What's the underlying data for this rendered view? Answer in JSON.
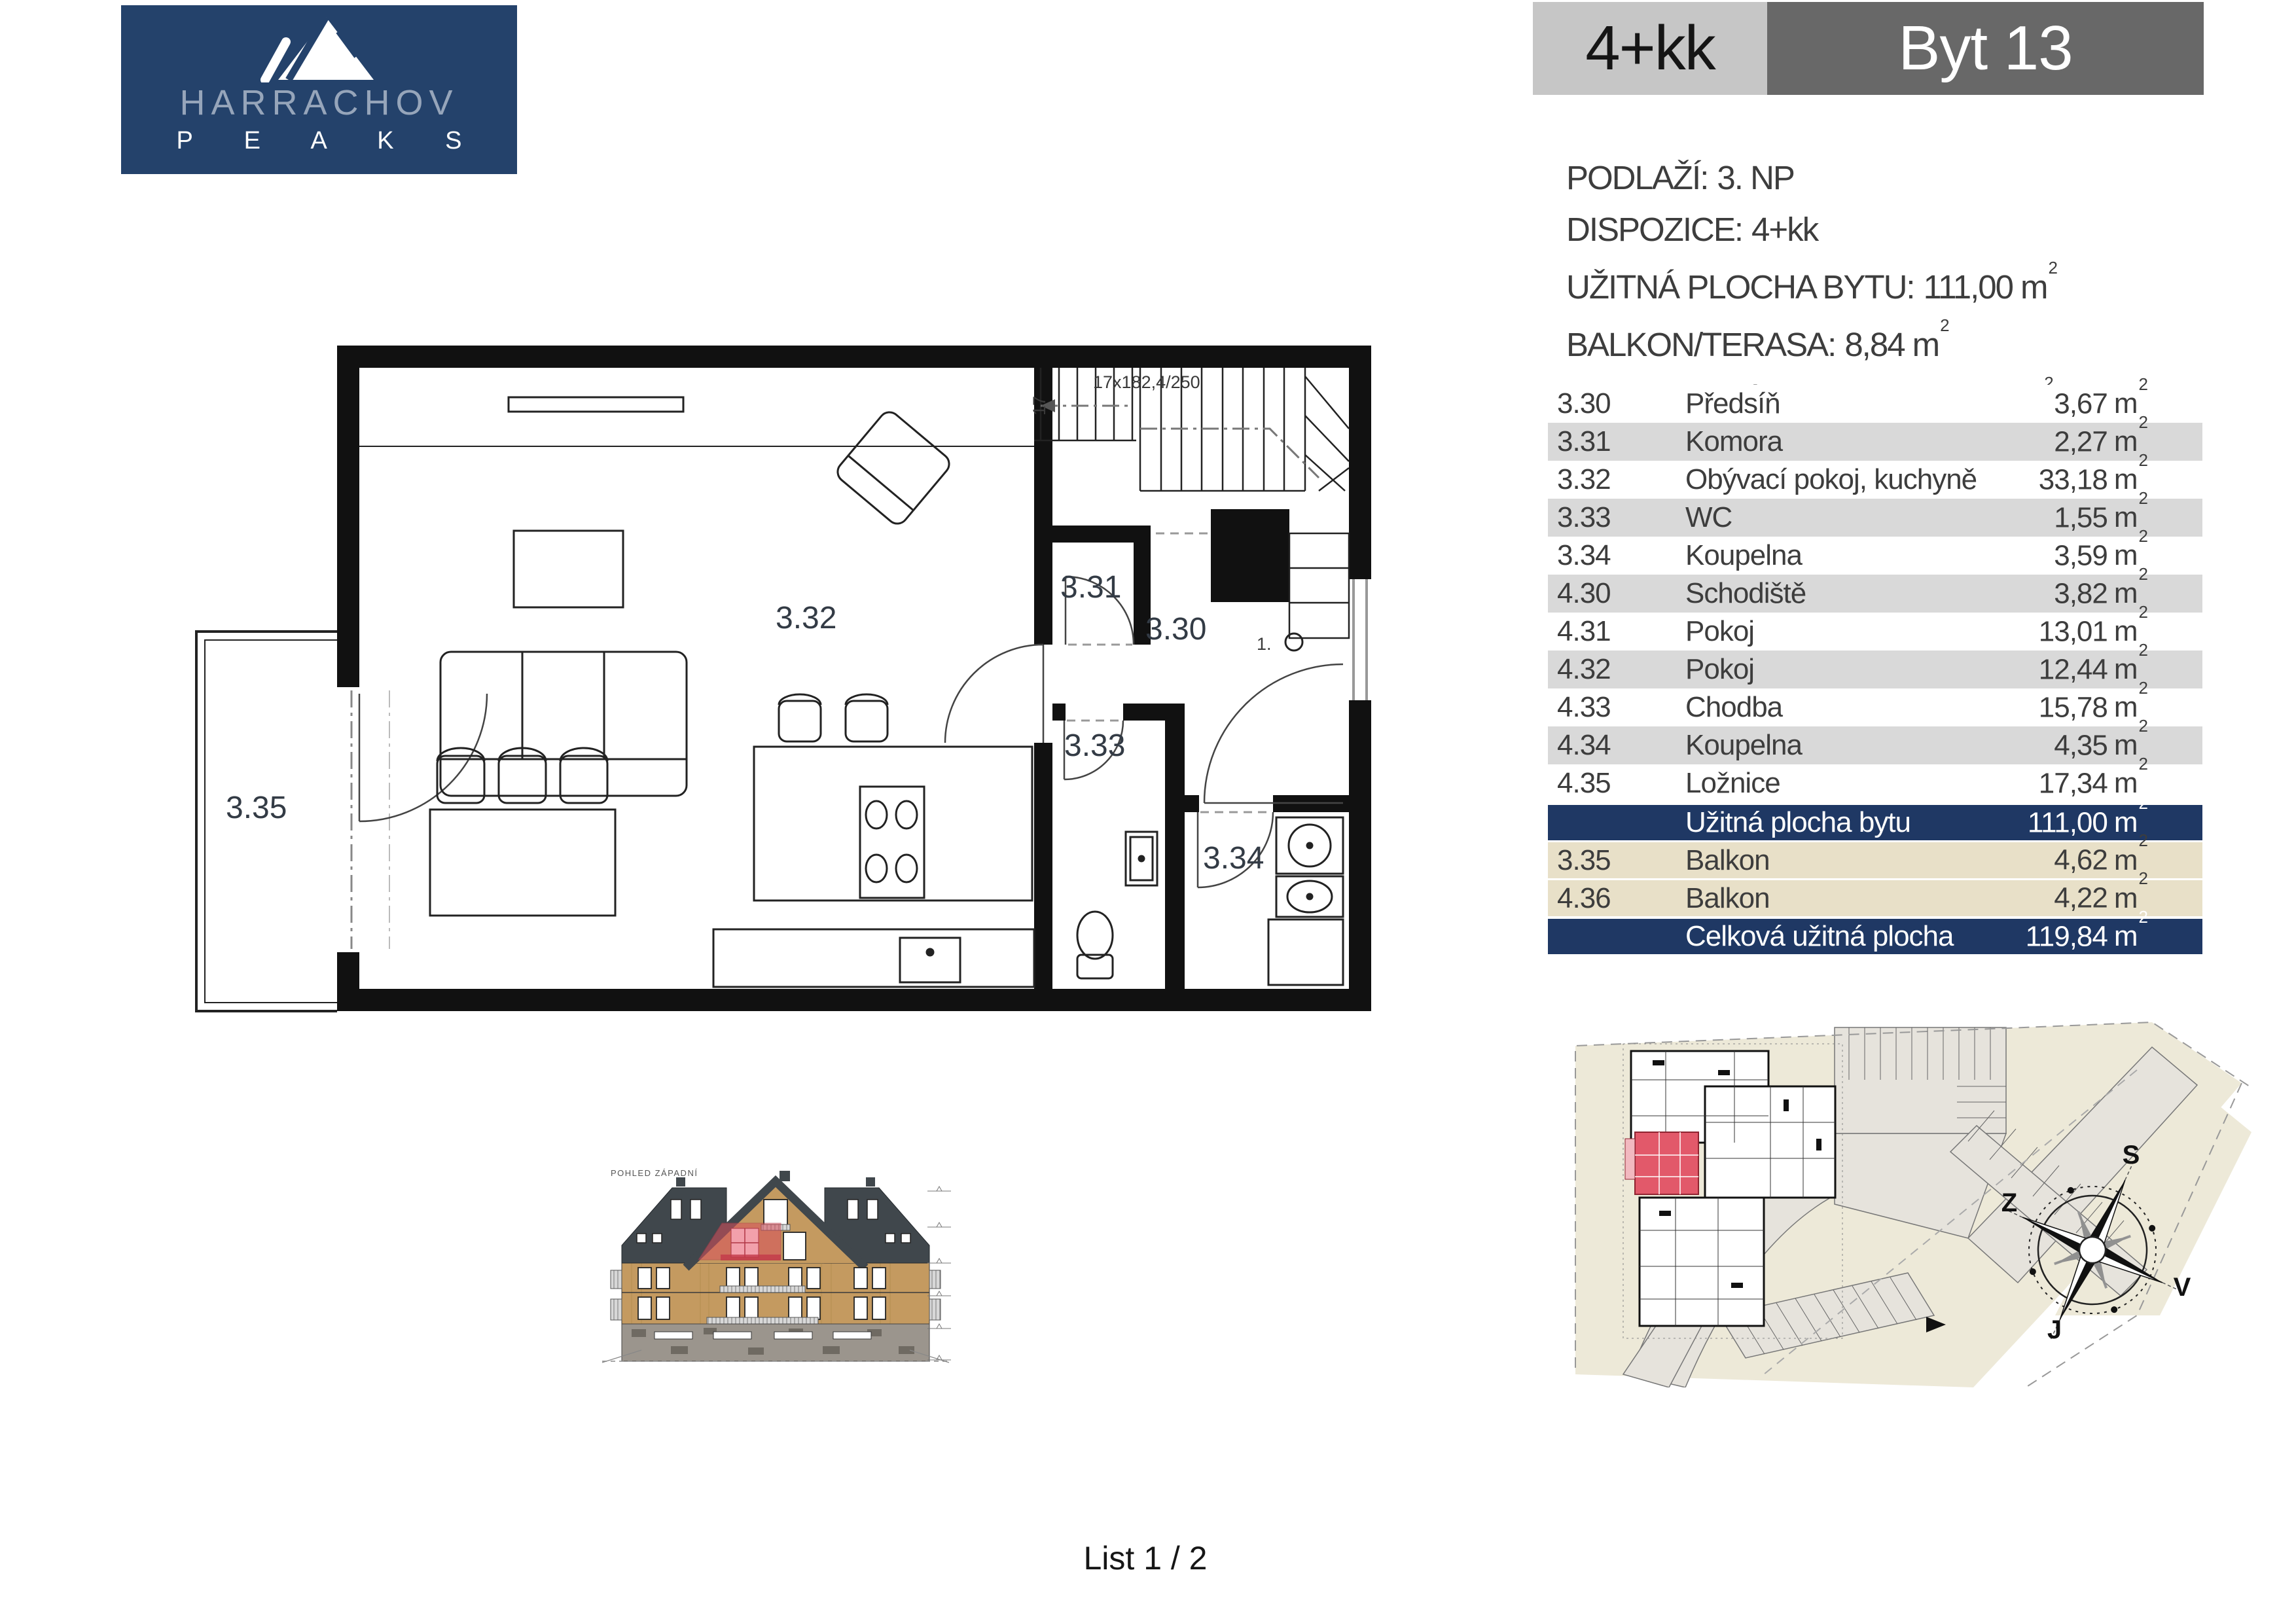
{
  "logo": {
    "icon": "mountain-icon",
    "brand_top": "HARRACHOV",
    "brand_bottom": "P E A K S"
  },
  "header": {
    "layout_label": "4+kk",
    "unit_label": "Byt 13"
  },
  "details": {
    "lines": [
      {
        "label": "PODLAŽÍ:",
        "value": "3. NP"
      },
      {
        "label": "DISPOZICE:",
        "value": "4+kk"
      },
      {
        "label": "UŽITNÁ PLOCHA BYTU:",
        "value": "111,00",
        "unit": "m",
        "exp": "2"
      },
      {
        "label": "BALKON/TERASA:",
        "value": "8,84",
        "unit": "m",
        "exp": "2"
      },
      {
        "label": "PODLAHOVÁ PLOCHA:",
        "value": "115,10",
        "unit": "m",
        "exp": "2",
        "suffix": "dle"
      },
      {
        "note": "Nařízení vlády č.366/2013 Sb."
      }
    ]
  },
  "table": {
    "unit": "m",
    "exp": "2",
    "rows": [
      {
        "code": "3.30",
        "name": "Předsíň",
        "area": "3,67"
      },
      {
        "code": "3.31",
        "name": "Komora",
        "area": "2,27"
      },
      {
        "code": "3.32",
        "name": "Obývací pokoj, kuchyně",
        "area": "33,18"
      },
      {
        "code": "3.33",
        "name": "WC",
        "area": "1,55"
      },
      {
        "code": "3.34",
        "name": "Koupelna",
        "area": "3,59"
      },
      {
        "code": "4.30",
        "name": "Schodiště",
        "area": "3,82"
      },
      {
        "code": "4.31",
        "name": "Pokoj",
        "area": "13,01"
      },
      {
        "code": "4.32",
        "name": "Pokoj",
        "area": "12,44"
      },
      {
        "code": "4.33",
        "name": "Chodba",
        "area": "15,78"
      },
      {
        "code": "4.34",
        "name": "Koupelna",
        "area": "4,35"
      },
      {
        "code": "4.35",
        "name": "Ložnice",
        "area": "17,34"
      }
    ],
    "summary_usable": {
      "label": "Užitná plocha bytu",
      "area": "111,00"
    },
    "balconies": [
      {
        "code": "3.35",
        "name": "Balkon",
        "area": "4,62"
      },
      {
        "code": "4.36",
        "name": "Balkon",
        "area": "4,22"
      }
    ],
    "summary_total": {
      "label": "Celková užitná plocha",
      "area": "119,84"
    }
  },
  "floorplan": {
    "rooms": {
      "r330": "3.30",
      "r331": "3.31",
      "r332": "3.32",
      "r333": "3.33",
      "r334": "3.34",
      "r335": "3.35"
    },
    "stair_note": "17x182,4/250",
    "stair_count": "17",
    "stair_start": "1."
  },
  "elevation": {
    "title": "POHLED ZÁPADNÍ"
  },
  "siteplan": {
    "compass": {
      "north": "S",
      "west": "Z",
      "east": "V",
      "south": "J"
    }
  },
  "footer": {
    "page": "List 1 / 2"
  },
  "colors": {
    "brand_navy": "#24426B",
    "table_navy": "#1F3864",
    "row_gray": "#D9D9D9",
    "row_beige": "#E8E0C8",
    "header_light_gray": "#C6C6C6",
    "header_dark_gray": "#686868",
    "highlight_red": "#D94F5C",
    "parcel_beige": "#EDE9D8"
  }
}
